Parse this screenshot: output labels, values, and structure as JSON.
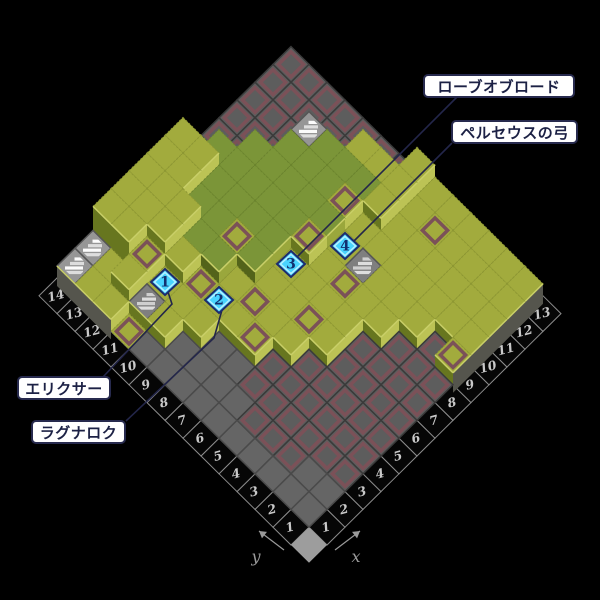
{
  "scene": {
    "width": 600,
    "height": 600,
    "background": "#000000"
  },
  "axes": {
    "x_label": "x",
    "y_label": "y",
    "x_ticks": [
      1,
      2,
      3,
      4,
      5,
      6,
      7,
      8,
      9,
      10,
      11,
      12,
      13
    ],
    "y_ticks": [
      1,
      2,
      3,
      4,
      5,
      6,
      7,
      8,
      9,
      10,
      11,
      12,
      13,
      14
    ],
    "tick_color": "#c9c9c9",
    "cell_fill": "#060606",
    "cell_stroke": "#8d8d8d",
    "arrow_color": "#9a9a9a"
  },
  "map": {
    "columns": 13,
    "rows": 14,
    "origin": [
      309,
      545
    ],
    "step": [
      18,
      17.8
    ],
    "height_unit": 12,
    "legend": {
      "G": "grass",
      "D": "dark-grass",
      "B": "grass-red-border",
      "R": "stone-red-border",
      "g": "stone-plain",
      "W": "stairs-white",
      "w": "stairs-gray"
    },
    "grid": [
      [
        "W1",
        "W1",
        "G3",
        "G3",
        "G3",
        "G3",
        "G3",
        "R0",
        "R0",
        "R0",
        "R0",
        "R0",
        "R0"
      ],
      [
        "G1",
        "G1",
        "G3",
        "G3",
        "G3",
        "G3",
        "G3",
        "D2",
        "R0",
        "R0",
        "R0",
        "R0",
        "R0"
      ],
      [
        "G1",
        "G2",
        "B2",
        "G3",
        "G3",
        "D2",
        "D2",
        "D2",
        "D2",
        "R0",
        "R0",
        "R0",
        "R0"
      ],
      [
        "B0",
        "w1",
        "G1",
        "G2",
        "D2",
        "D2",
        "D2",
        "D2",
        "D2",
        "D2",
        "W2",
        "R0",
        "R0"
      ],
      [
        "g0",
        "G1",
        "G1",
        "B1",
        "D2",
        "B2",
        "D2",
        "D2",
        "D2",
        "D2",
        "D2",
        "R0",
        "R0"
      ],
      [
        "g0",
        "g0",
        "G1",
        "G1",
        "G1",
        "D2",
        "D2",
        "D2",
        "D2",
        "D2",
        "D2",
        "G2",
        "R0"
      ],
      [
        "g0",
        "g0",
        "g0",
        "G1",
        "B1",
        "G1",
        "G1",
        "B2",
        "D2",
        "B2",
        "D2",
        "G2",
        "R0"
      ],
      [
        "g0",
        "g0",
        "g0",
        "B1",
        "G1",
        "G1",
        "G1",
        "G1",
        "G1",
        "G1",
        "G2",
        "G2",
        "G2"
      ],
      [
        "g0",
        "g0",
        "R0",
        "R0",
        "G1",
        "B1",
        "G1",
        "B1",
        "w1",
        "G1",
        "G1",
        "G1",
        "G1"
      ],
      [
        "g0",
        "R0",
        "R0",
        "R0",
        "R0",
        "G1",
        "G1",
        "G1",
        "G1",
        "G1",
        "G1",
        "B1",
        "G1"
      ],
      [
        "g0",
        "R0",
        "R0",
        "R0",
        "R0",
        "R0",
        "R0",
        "G1",
        "G1",
        "G1",
        "G1",
        "G1",
        "G1"
      ],
      [
        "g0",
        "R0",
        "R0",
        "R0",
        "R0",
        "R0",
        "R0",
        "R0",
        "G1",
        "G1",
        "G1",
        "G1",
        "G1"
      ],
      [
        "g0",
        "g0",
        "R0",
        "R0",
        "R0",
        "R0",
        "R0",
        "R0",
        "R0",
        "G1",
        "G1",
        "G1",
        "G1"
      ],
      [
        "g0",
        "g0",
        "R0",
        "R0",
        "R0",
        "R0",
        "R0",
        "R0",
        "B1",
        "G1",
        "G1",
        "G1",
        "G1"
      ]
    ]
  },
  "palette": {
    "grass": "#a2ab3d",
    "grass_seam": "#8d9733",
    "dark_grass": "#7b9538",
    "dark_grass_seam": "#6b842e",
    "border_red": "#7b5158",
    "stone": "#5d5d5d",
    "stone_seam": "#3a3a3a",
    "stone_plain": "#656565",
    "stone_plain_seam": "#4a4a4a",
    "wall_se": "#bcc355",
    "wall_sw": "#67761f",
    "wall_se_dark": "#9aa73c",
    "wall_sw_dark": "#53631a",
    "edge_wall": "#55554d",
    "lip": "#c9cf68",
    "stairs_bg": "#969696",
    "stairs_step": "#fbfbfb",
    "stairs_bg2": "#7f7f7f",
    "stairs_step2": "#cfcfcf",
    "line": "#23264a",
    "marker_fill": "#49d4ff",
    "marker_inner": "#b9f1ff",
    "marker_border": "#1d2c6e",
    "marker_text": "#123070",
    "origin_fill": "#9d9d9d"
  },
  "markers": [
    {
      "number": "1",
      "item": "エリクサー",
      "cell": [
        3,
        11
      ],
      "screen": [
        165,
        282
      ]
    },
    {
      "number": "2",
      "item": "ラグナロク",
      "cell": [
        4,
        9
      ],
      "screen": [
        219,
        300
      ]
    },
    {
      "number": "3",
      "item": "ローブオブロード",
      "cell": [
        7,
        8
      ],
      "screen": [
        291,
        264
      ]
    },
    {
      "number": "4",
      "item": "ペルセウスの弓",
      "cell": [
        9,
        7
      ],
      "screen": [
        345,
        246
      ]
    }
  ],
  "labels": [
    {
      "id": "robe-of-lords",
      "text": "ローブオブロード",
      "x": 423,
      "y": 74,
      "w": 152,
      "h": 24
    },
    {
      "id": "perseus-bow",
      "text": "ペルセウスの弓",
      "x": 451,
      "y": 120,
      "w": 127,
      "h": 24
    },
    {
      "id": "elixir",
      "text": "エリクサー",
      "x": 17,
      "y": 376,
      "w": 94,
      "h": 24
    },
    {
      "id": "ragnarok",
      "text": "ラグナロク",
      "x": 31,
      "y": 420,
      "w": 95,
      "h": 24
    }
  ],
  "connectors": [
    {
      "to_marker": "3",
      "points": [
        [
          457,
          97
        ],
        [
          297,
          257
        ]
      ]
    },
    {
      "to_marker": "4",
      "points": [
        [
          452,
          143
        ],
        [
          352,
          243
        ]
      ]
    },
    {
      "to_marker": "1",
      "points": [
        [
          103,
          377
        ],
        [
          172,
          304
        ],
        [
          168,
          292
        ]
      ]
    },
    {
      "to_marker": "2",
      "points": [
        [
          126,
          421
        ],
        [
          214,
          338
        ],
        [
          222,
          310
        ]
      ]
    }
  ]
}
